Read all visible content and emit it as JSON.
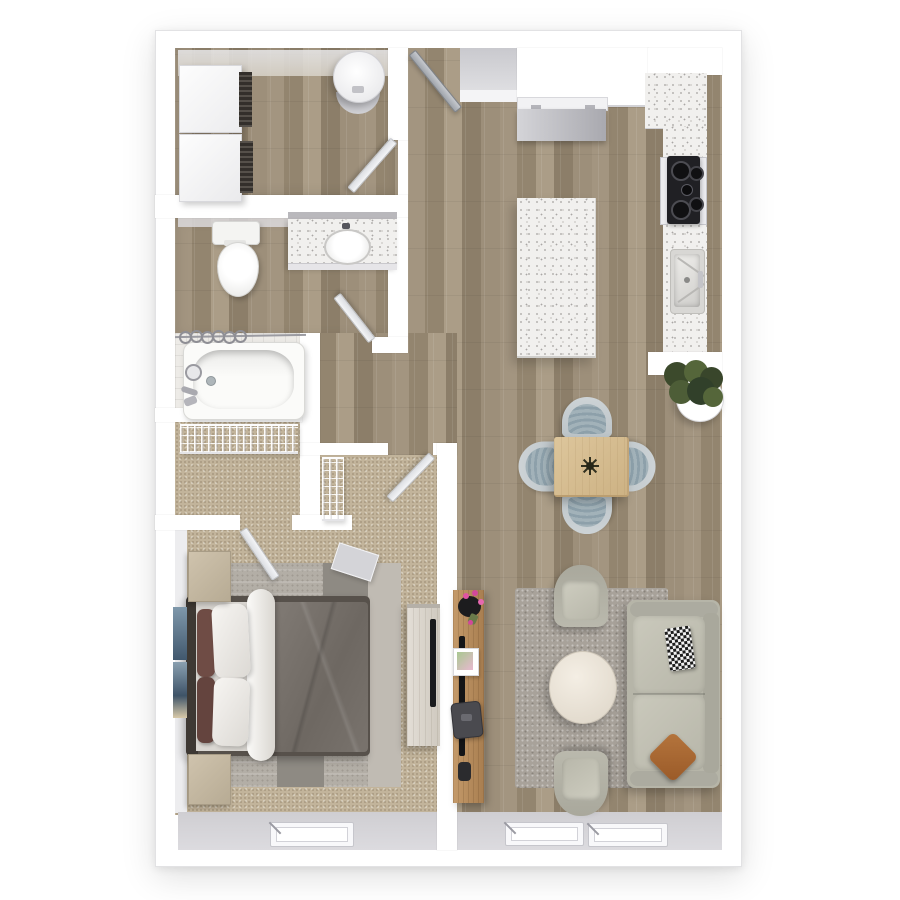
{
  "meta": {
    "type": "floor-plan",
    "description": "Top-down 3D rendered one-bedroom apartment floor plan with white walls, wood-look flooring in main areas and carpet in bedroom/closet",
    "units_shown": "none (no text or dimensions rendered in image)"
  },
  "colors": {
    "wall": "#ffffff",
    "wood": "#9a8c77",
    "carpet": "#c2b49b",
    "tile": "#edebe7",
    "granite": "#f1f0ee",
    "gray-base": "#d4d3d7",
    "rug-living": "#a8a29a",
    "rug-bed": "#b3aea6",
    "sofa": "#b6b5a8",
    "chair-shell": "#c6cdd0",
    "chair-cushion": "#93a5ae",
    "table-wood": "#d8bf93",
    "desk-wood": "#b98d5e",
    "dresser-wood": "#ded9d0",
    "duvet": "#7b7570",
    "bed-frame": "#55504a",
    "pillow-maroon": "#6f4c45",
    "pillow-leather": "#a8662f",
    "plant-dark": "#3c4a2c",
    "plant-light": "#55663a",
    "flower-pink": "#e054a2",
    "appliance": "#bfbfc4",
    "cooktop-black": "#202024"
  },
  "rooms": [
    {
      "id": "laundry",
      "label": "Laundry / Utility Room",
      "floor": "wood",
      "contents": [
        "stacked washer-dryer pair",
        "water heater cylinder",
        "swing door"
      ]
    },
    {
      "id": "bathroom",
      "label": "Bathroom",
      "floor": "wood with tiled tub alcove",
      "contents": [
        "toilet",
        "granite vanity with oval sink",
        "bathtub with shower",
        "shower curtain rod with rings",
        "swing door"
      ]
    },
    {
      "id": "closet",
      "label": "Walk-in Closet",
      "floor": "carpet",
      "contents": [
        "wire shelving along wall",
        "swing door to bedroom"
      ]
    },
    {
      "id": "bedroom",
      "label": "Bedroom",
      "floor": "carpet",
      "contents": [
        "queen bed with gray duvet and white/maroon pillows",
        "patchwork gray area rug",
        "two wood nightstands",
        "leaning wall art",
        "whitewashed media dresser with TV",
        "small gray bench",
        "closet nook with wire shelf",
        "window",
        "swing door"
      ]
    },
    {
      "id": "entry",
      "label": "Entry",
      "floor": "wood",
      "contents": [
        "front door",
        "coat nook panel"
      ]
    },
    {
      "id": "kitchen",
      "label": "Kitchen",
      "floor": "wood",
      "contents": [
        "refrigerator",
        "white counter run",
        "L-shaped granite counter",
        "black 4-burner cooktop",
        "single-basin sink",
        "granite island",
        "half-wall counter end"
      ]
    },
    {
      "id": "dining",
      "label": "Dining Area",
      "floor": "wood",
      "contents": [
        "square light-wood table",
        "4 blue-gray tub chairs",
        "dark twig centerpiece",
        "potted plant in white pot"
      ]
    },
    {
      "id": "living",
      "label": "Living Room",
      "floor": "wood",
      "contents": [
        "sage-gray sofa",
        "black-white checkered pillow",
        "caramel leather pillow",
        "two gray armchairs",
        "round cream coffee table",
        "gray area rug",
        "oak media desk with TV",
        "black vase with pink flowers",
        "picture frame",
        "laptop",
        "two windows"
      ]
    }
  ],
  "doors": [
    "front entry door",
    "laundry door",
    "bathroom door",
    "bedroom door",
    "closet door"
  ],
  "windows": [
    "bedroom window",
    "living room window 1",
    "living room window 2"
  ]
}
